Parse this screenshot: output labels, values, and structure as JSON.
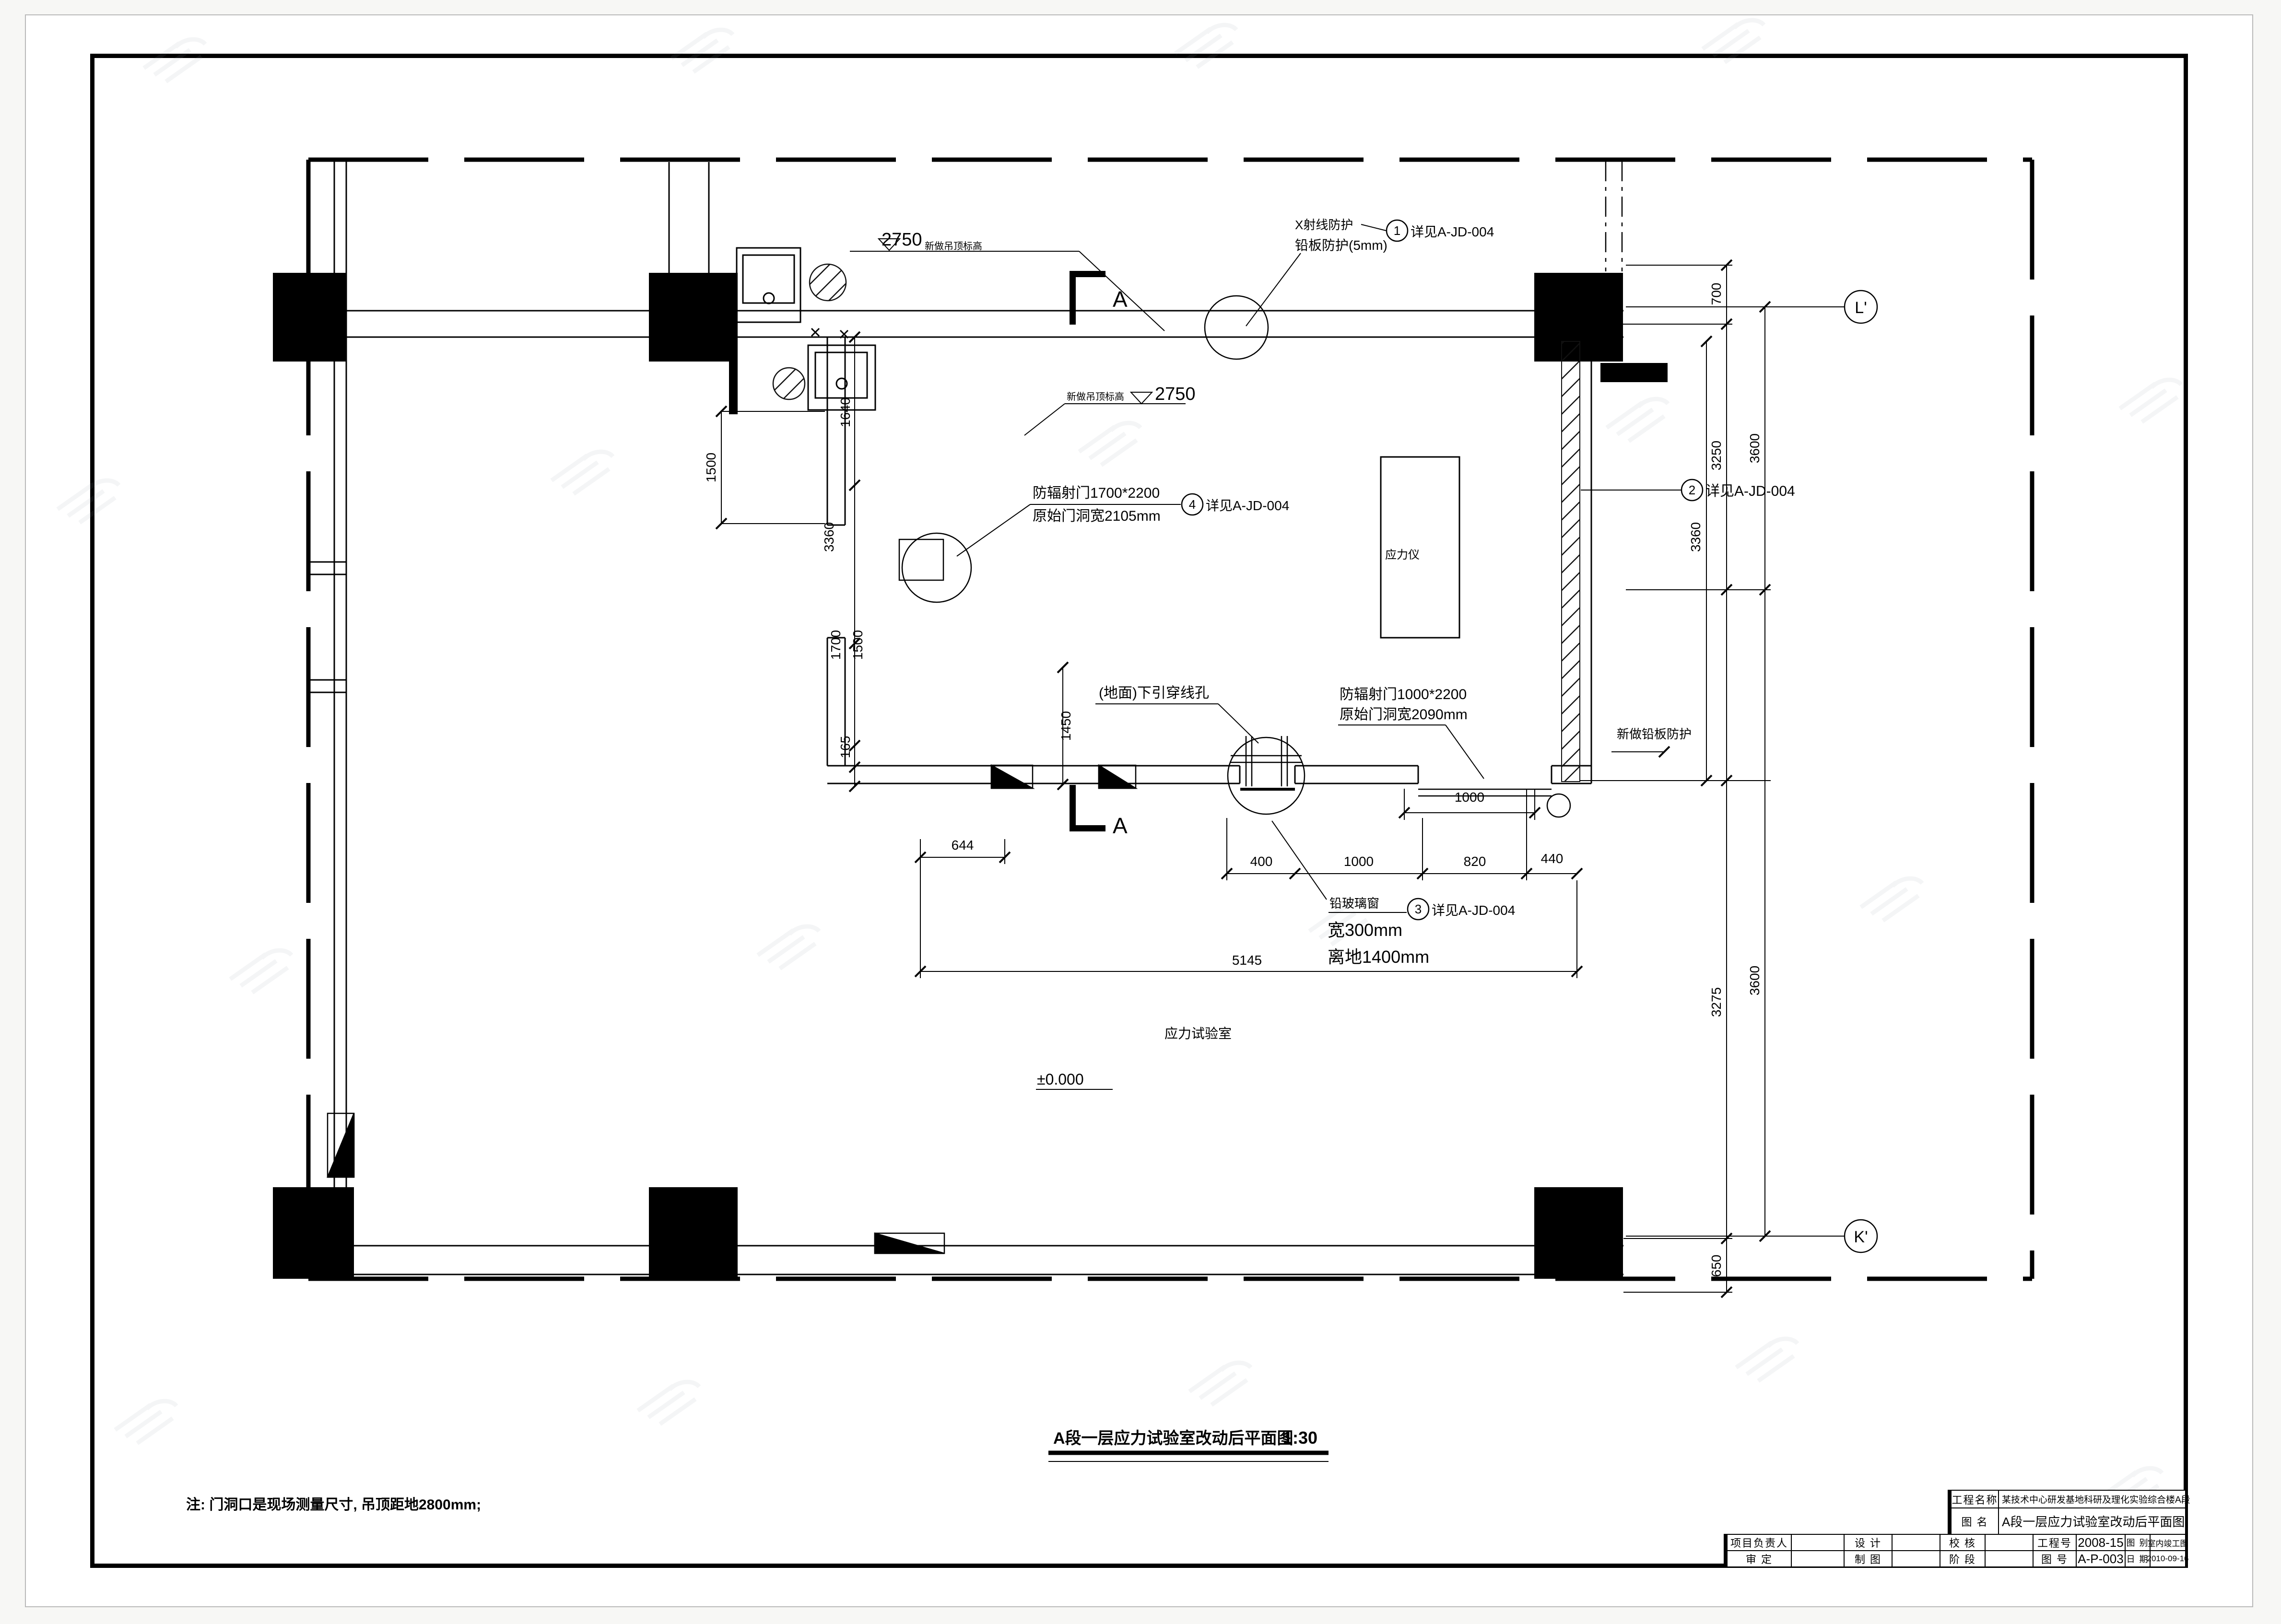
{
  "drawing": {
    "title": "A段一层应力试验室改动后平面图",
    "scale": "1:30",
    "note": "注: 门洞口是现场测量尺寸, 吊顶距地2800mm;",
    "room_label": "应力试验室",
    "equipment_label": "应力仪",
    "level_marker": "±0.000",
    "section_marker": "A"
  },
  "elevation_markers": [
    {
      "value": "2750",
      "label": "新做吊顶标高"
    },
    {
      "value": "2750",
      "label": "新做吊顶标高"
    }
  ],
  "callouts": {
    "xray_line1": "X射线防护",
    "xray_line2": "铅板防护(5mm)",
    "door_a_line1": "防辐射门1700*2200",
    "door_a_line2": "原始门洞宽2105mm",
    "door_b_line1": "防辐射门1000*2200",
    "door_b_line2": "原始门洞宽2090mm",
    "window_line1": "铅玻璃窗",
    "window_line2": "宽300mm",
    "window_line3": "离地1400mm",
    "floor_hole": "(地面)下引穿线孔",
    "lead_wall": "新做铅板防护",
    "ref1_num": "1",
    "ref1_text": "详见A-JD-004",
    "ref2_num": "2",
    "ref2_text": "详见A-JD-004",
    "ref3_num": "3",
    "ref3_text": "详见A-JD-004",
    "ref4_num": "4",
    "ref4_text": "详见A-JD-004"
  },
  "grid": {
    "bubble_top": "L'",
    "bubble_bottom": "K'"
  },
  "dimensions": {
    "bottom": [
      "644",
      "400",
      "1000",
      "820",
      "440",
      "1000",
      "5145"
    ],
    "left": [
      "1500",
      "1640",
      "3360",
      "1700",
      "1500",
      "165",
      "1450"
    ],
    "right": [
      "700",
      "3250",
      "3600",
      "3360",
      "3275",
      "3600",
      "650"
    ]
  },
  "title_block": {
    "project_label": "工程名称",
    "project_value": "某技术中心研发基地科研及理化实验综合楼A段",
    "name_label": "图  名",
    "name_value": "A段一层应力试验室改动后平面图",
    "row1": [
      {
        "label": "项目负责人",
        "value": ""
      },
      {
        "label": "设  计",
        "value": ""
      },
      {
        "label": "校  核",
        "value": ""
      },
      {
        "label": "工程号",
        "value": "2008-15"
      },
      {
        "label": "图  别",
        "value": "室内竣工图"
      }
    ],
    "row2": [
      {
        "label": "审  定",
        "value": ""
      },
      {
        "label": "制  图",
        "value": ""
      },
      {
        "label": "阶  段",
        "value": ""
      },
      {
        "label": "图  号",
        "value": "A-P-003"
      },
      {
        "label": "日  期",
        "value": "2010-09-16"
      }
    ]
  }
}
